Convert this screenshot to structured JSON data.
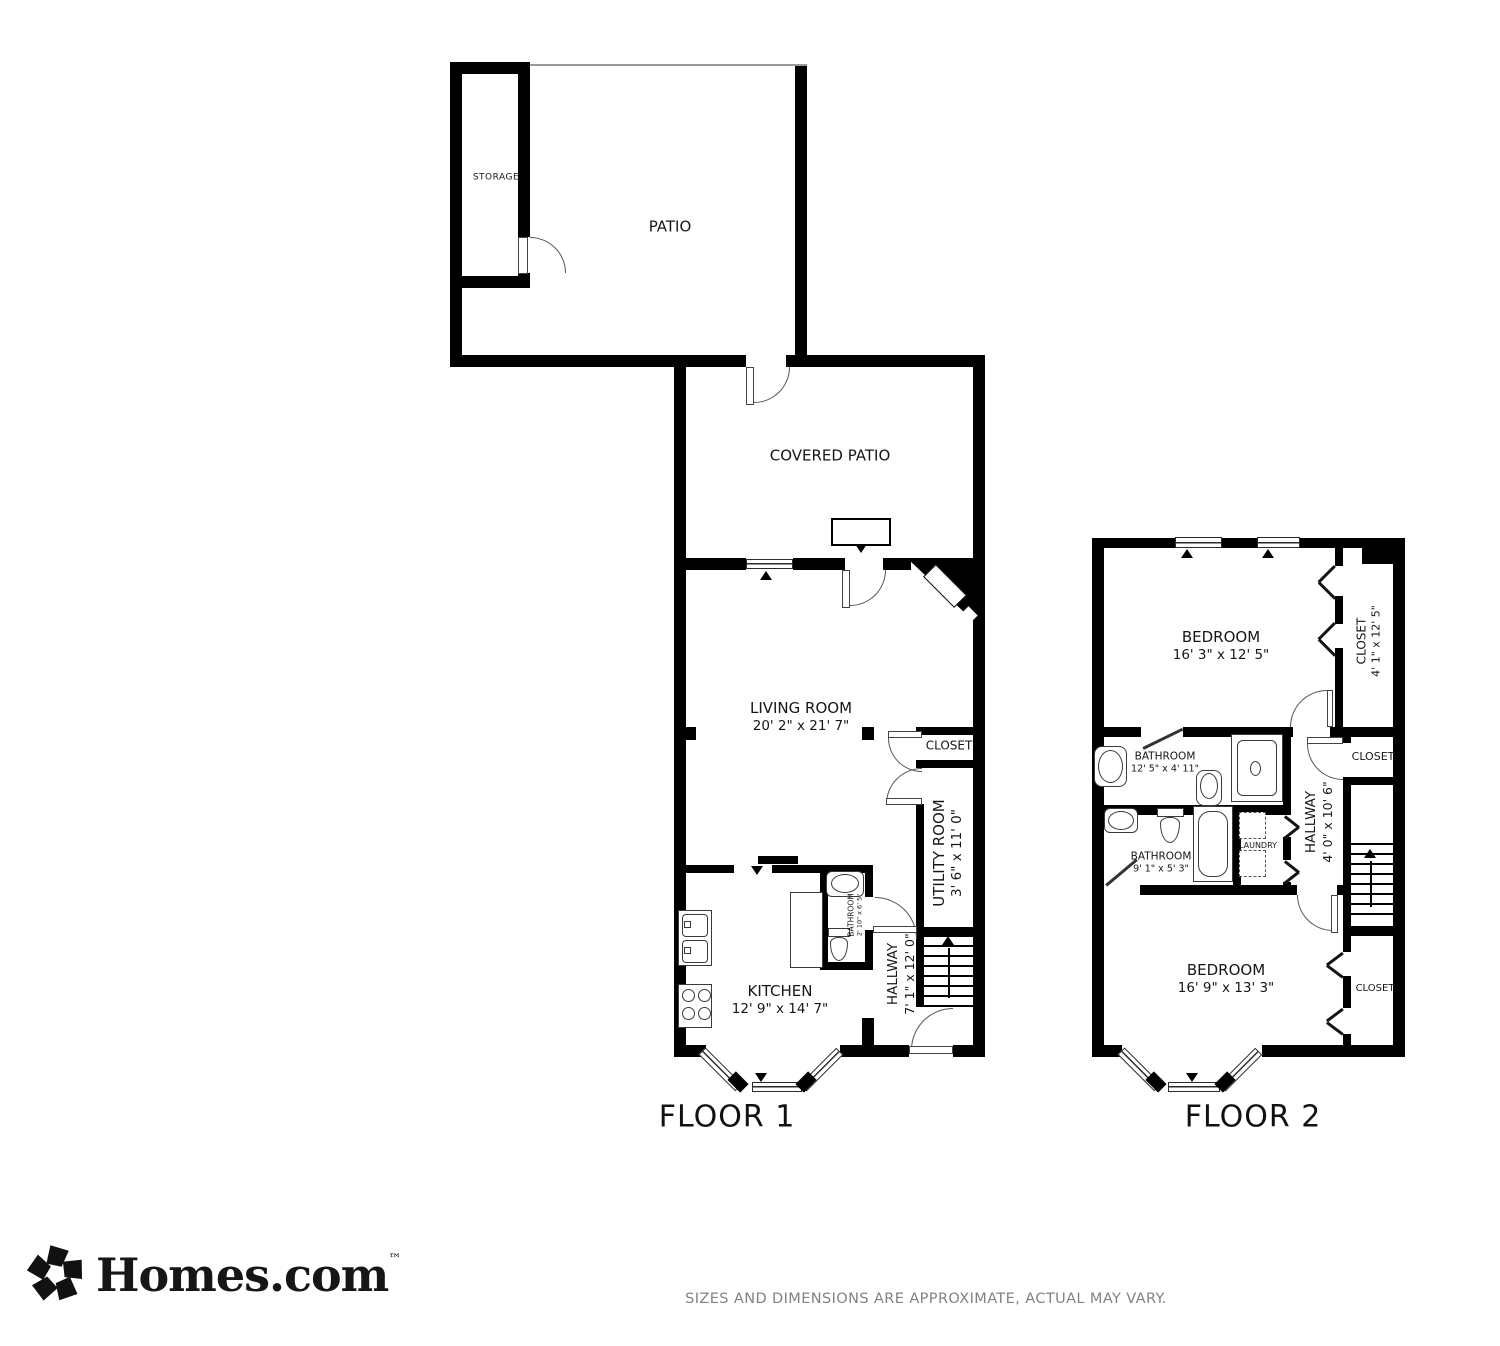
{
  "floor1": {
    "label": "FLOOR 1",
    "rooms": {
      "storage": {
        "name": "STORAGE"
      },
      "patio": {
        "name": "PATIO"
      },
      "covered_patio": {
        "name": "COVERED PATIO"
      },
      "living_room": {
        "name": "LIVING ROOM",
        "dims": "20' 2\" x 21' 7\""
      },
      "closet": {
        "name": "CLOSET"
      },
      "utility_room": {
        "name": "UTILITY ROOM",
        "dims": "3' 6\" x 11' 0\""
      },
      "bathroom": {
        "name": "BATHROOM",
        "dims": "2' 10\" x 6' 5\""
      },
      "hallway": {
        "name": "HALLWAY",
        "dims": "7' 1\" x 12' 0\""
      },
      "kitchen": {
        "name": "KITCHEN",
        "dims": "12' 9\" x 14' 7\""
      }
    }
  },
  "floor2": {
    "label": "FLOOR 2",
    "rooms": {
      "bedroom_top": {
        "name": "BEDROOM",
        "dims": "16' 3\" x 12' 5\""
      },
      "closet_top": {
        "name": "CLOSET",
        "dims": "4' 1\" x 12' 5\""
      },
      "bathroom_top": {
        "name": "BATHROOM",
        "dims": "12' 5\" x 4' 11\""
      },
      "closet_mid": {
        "name": "CLOSET"
      },
      "hallway": {
        "name": "HALLWAY",
        "dims": "4' 0\" x 10' 6\""
      },
      "bathroom_mid": {
        "name": "BATHROOM",
        "dims": "9' 1\" x 5' 3\""
      },
      "laundry": {
        "name": "LAUNDRY"
      },
      "bedroom_bottom": {
        "name": "BEDROOM",
        "dims": "16' 9\" x 13' 3\""
      },
      "closet_bottom": {
        "name": "CLOSET"
      }
    }
  },
  "footer": {
    "brand": "Homes.com",
    "trademark": "™",
    "disclaimer": "SIZES AND DIMENSIONS ARE APPROXIMATE, ACTUAL MAY VARY."
  },
  "colors": {
    "wall": "#000000",
    "line": "#3a3a3a",
    "text": "#161616",
    "disclaimer_text": "#828282"
  }
}
